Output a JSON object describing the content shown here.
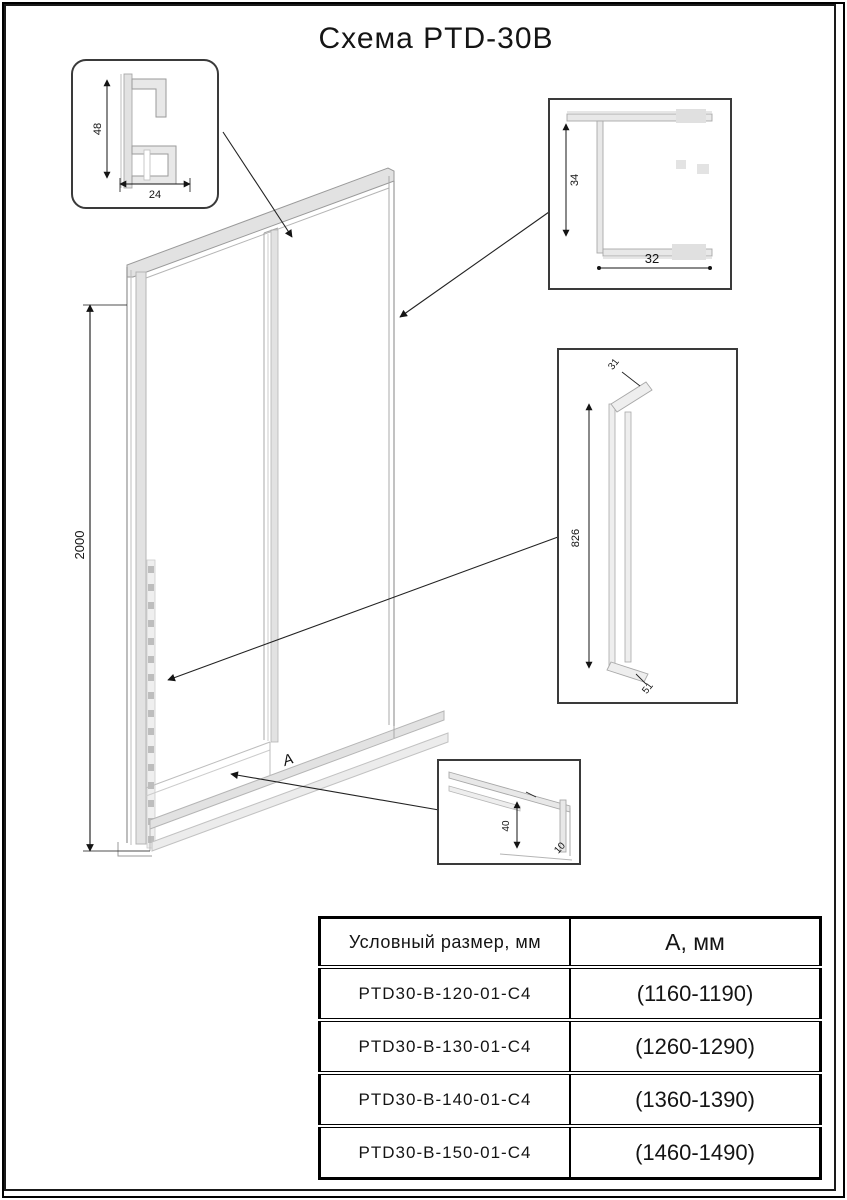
{
  "title": "Схема PTD-30B",
  "drawing": {
    "door_height": "2000",
    "width_label": "A",
    "detail_top_left": {
      "height": "48",
      "width": "24"
    },
    "detail_top_right": {
      "height": "34",
      "width": "32"
    },
    "detail_handle": {
      "length": "826",
      "top": "31",
      "bottom": "51"
    },
    "detail_bottom": {
      "height": "40",
      "depth": "10"
    }
  },
  "table": {
    "col1_header": "Условный размер, мм",
    "col2_header": "А, мм",
    "rows": [
      {
        "model": "PTD30-B-120-01-C4",
        "range": "(1160-1190)"
      },
      {
        "model": "PTD30-B-130-01-C4",
        "range": "(1260-1290)"
      },
      {
        "model": "PTD30-B-140-01-C4",
        "range": "(1360-1390)"
      },
      {
        "model": "PTD30-B-150-01-C4",
        "range": "(1460-1490)"
      }
    ]
  }
}
